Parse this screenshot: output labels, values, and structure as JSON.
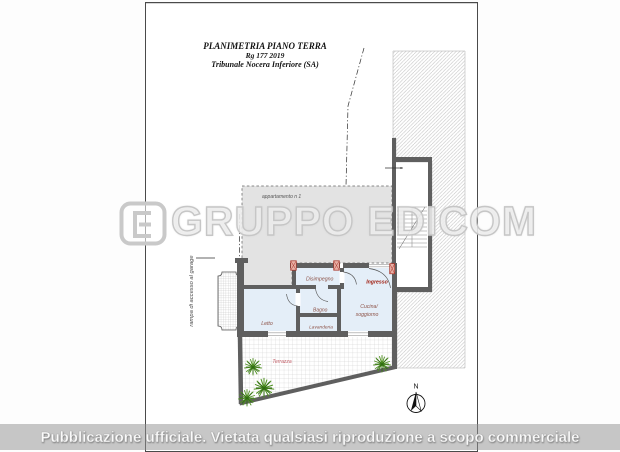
{
  "title_block": {
    "line1": "PLANIMETRIA PIANO TERRA",
    "line2": "Rg 177 2019",
    "line3": "Tribunale Nocera Inferiore (SA)"
  },
  "plan": {
    "overhang_label": "appartamento n 1",
    "ramp_label": "rampa di accesso al garage",
    "rooms": {
      "disimpegno": "Disimpegno",
      "ingresso": "Ingresso",
      "cucina_line1": "Cucina/",
      "cucina_line2": "soggiorno",
      "bagno": "Bagno",
      "lavanderia": "Lavanderia",
      "letto": "Letto",
      "terrazza": "Terrazza"
    },
    "compass": {
      "north_label": "N"
    },
    "colors": {
      "wall_gray": "#5f5f5f",
      "room_fill_blue": "#e4eef8",
      "overhang_fill_gray": "#e3e3e3",
      "door_marker_red": "#a93226",
      "entry_label_red": "#9e1a0c",
      "room_label_brown": "#8d5348",
      "terrace_label_red": "#c4606a",
      "plant_green": "#4e8f1f",
      "watermark_gray": "#c6c6c6"
    }
  },
  "watermark": {
    "logo_icon": "edicom-logo",
    "text": "GRUPPO EDICOM"
  },
  "footer": {
    "text": "Pubblicazione ufficiale. Vietata qualsiasi riproduzione a scopo commerciale"
  }
}
